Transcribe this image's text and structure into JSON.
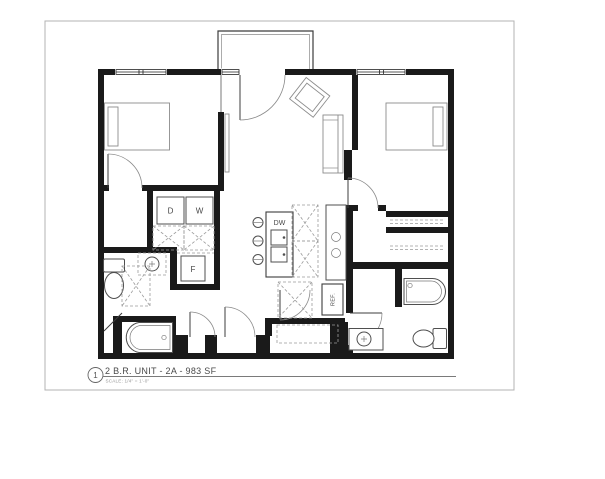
{
  "sheet": {
    "callout_number": "1",
    "title": "2 B.R. UNIT - 2A - 983 SF",
    "scale_note": "SCALE: 1/4\" = 1'-0\"",
    "appliance_labels": {
      "dryer": "D",
      "washer": "W",
      "furnace": "F",
      "dishwasher": "DW",
      "refrigerator": "REF."
    },
    "colors": {
      "wall": "#1a1a1a",
      "fixture_line": "#4f4f4f",
      "furniture_line": "#8c8c8c",
      "dashed_line": "#9b9b9b",
      "sheet_border": "#b3b3b3",
      "paper": "#ffffff"
    }
  }
}
